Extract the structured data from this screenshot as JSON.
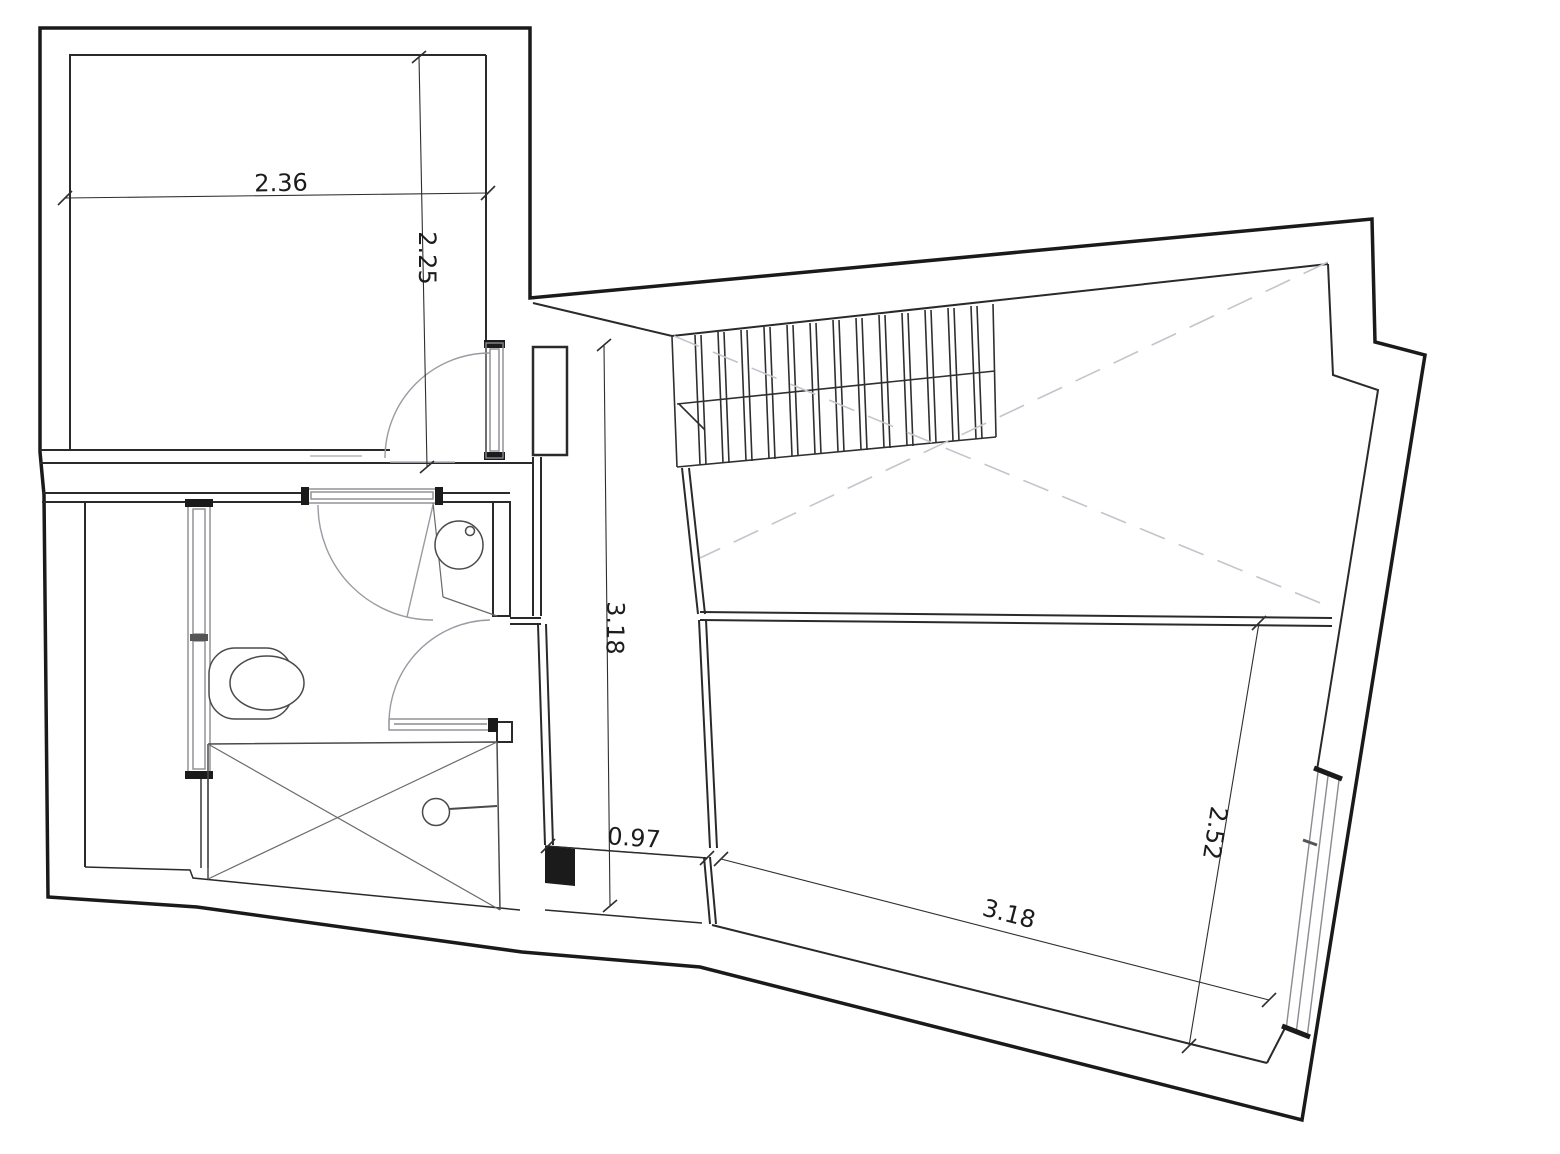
{
  "floor_plan": {
    "dimensions": {
      "top_room_width": "2.36",
      "top_room_depth": "2.25",
      "hall_depth": "3.18",
      "passage_width": "0.97",
      "main_room_width": "3.18",
      "main_room_depth": "2.52"
    },
    "fixtures": [
      "toilet",
      "washbasin",
      "shower",
      "staircase"
    ],
    "colors": {
      "wall": "#1a1a1a",
      "inner_wall": "#2a2a2a",
      "glazing": "#8a8a92",
      "swing": "#9a9aa2",
      "void_dash": "#c4c4cc",
      "dimension": "#2e2e2e"
    }
  }
}
